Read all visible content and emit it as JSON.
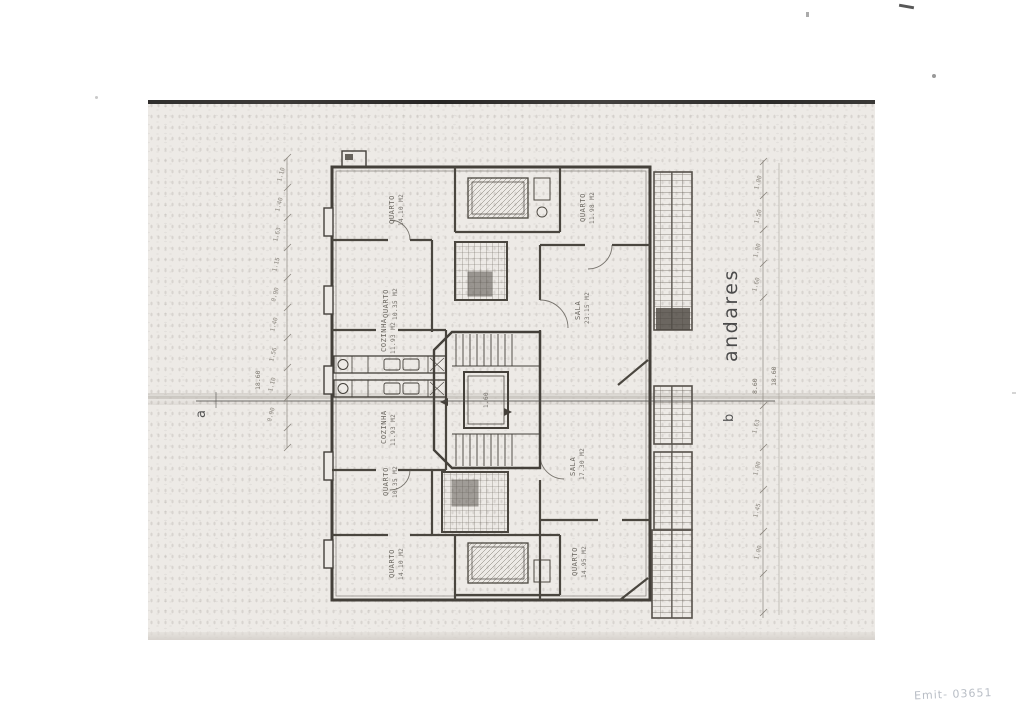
{
  "plan": {
    "floor_label": "andares",
    "section_marks": {
      "left": "a",
      "right": "b"
    },
    "rooms": [
      {
        "name": "QUARTO",
        "area": "14.10 M2"
      },
      {
        "name": "QUARTO",
        "area": "11.98 M2"
      },
      {
        "name": "QUARTO",
        "area": "10.35 M2"
      },
      {
        "name": "SALA",
        "area": "23.15 M2"
      },
      {
        "name": "COZINHA",
        "area": "11.93 M2"
      },
      {
        "name": "COZINHA",
        "area": "11.93 M2"
      },
      {
        "name": "QUARTO",
        "area": "10.35 M2"
      },
      {
        "name": "SALA",
        "area": "17.30 M2"
      },
      {
        "name": "QUARTO",
        "area": "14.10 M2"
      },
      {
        "name": "QUARTO",
        "area": "14.95 M2"
      }
    ],
    "elevator_dim": "1.60",
    "dim_left": {
      "segments": [
        "1.10",
        "1.40",
        "1.63",
        "1.15",
        "0.90",
        "1.40",
        "1.56",
        "1.10",
        "0.90"
      ],
      "total": "18.60"
    },
    "dim_right": {
      "segments_upper": [
        "1.00",
        "1.50",
        "1.00",
        "1.60"
      ],
      "mid_total": "8.60",
      "overall_total": "18.60",
      "segments_lower": [
        "1.63",
        "1.00",
        "1.45",
        "1.00"
      ]
    }
  },
  "annotations": {
    "handwritten_mark": "Emit- 03651"
  },
  "colors": {
    "wall_ink": "#44403a",
    "scan_paper": "#edeae6",
    "pencil_mark": "#8d95a2"
  }
}
